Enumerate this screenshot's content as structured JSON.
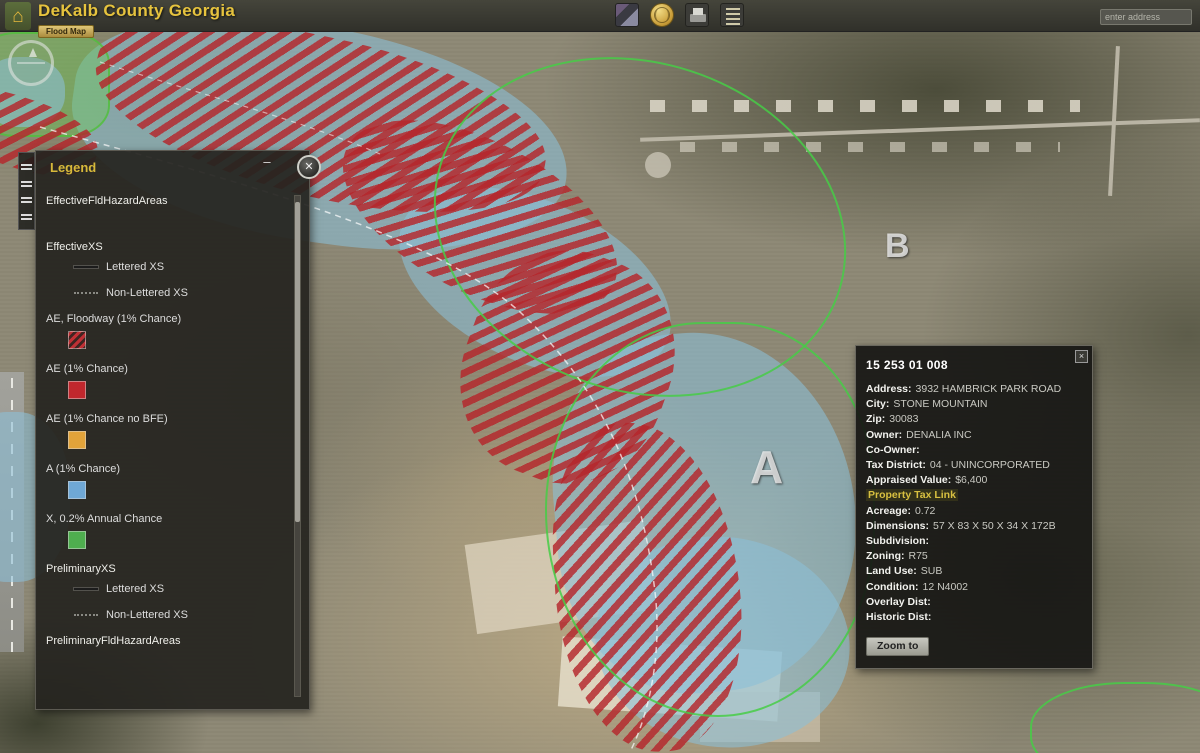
{
  "app": {
    "title": "DeKalb County Georgia",
    "subtitle_button": "Flood Map"
  },
  "header": {
    "search_placeholder": "enter address",
    "toolbar_icons": [
      "basemap-icon",
      "globe-icon",
      "print-icon",
      "layer-list-icon"
    ]
  },
  "legend": {
    "title": "Legend",
    "minimize_label": "–",
    "close_label": "✕",
    "items": [
      {
        "kind": "layer",
        "label": "EffectiveFldHazardAreas"
      },
      {
        "kind": "layer",
        "label": "EffectiveXS"
      },
      {
        "kind": "xs",
        "label": "Lettered XS"
      },
      {
        "kind": "xs",
        "label": "Non-Lettered XS"
      },
      {
        "kind": "class",
        "label": "AE, Floodway (1% Chance)",
        "swatch": "hatch",
        "color": "#b5262b"
      },
      {
        "kind": "class",
        "label": "AE (1% Chance)",
        "swatch": "solid",
        "color": "#c0272d"
      },
      {
        "kind": "class",
        "label": "AE (1% Chance no BFE)",
        "swatch": "solid",
        "color": "#e2a33a"
      },
      {
        "kind": "class",
        "label": "A (1% Chance)",
        "swatch": "solid",
        "color": "#6fa8d6"
      },
      {
        "kind": "class",
        "label": "X, 0.2% Annual Chance",
        "swatch": "solid",
        "color": "#4fae4f"
      },
      {
        "kind": "layer",
        "label": "PreliminaryXS"
      },
      {
        "kind": "xs",
        "label": "Lettered XS"
      },
      {
        "kind": "xs",
        "label": "Non-Lettered XS"
      },
      {
        "kind": "layer",
        "label": "PreliminaryFldHazardAreas"
      }
    ]
  },
  "popup": {
    "title": "15 253 01 008",
    "fields": [
      {
        "label": "Address:",
        "value": "3932 HAMBRICK PARK ROAD"
      },
      {
        "label": "City:",
        "value": "STONE MOUNTAIN"
      },
      {
        "label": "Zip:",
        "value": "30083"
      },
      {
        "label": "Owner:",
        "value": "DENALIA INC"
      },
      {
        "label": "Co-Owner:",
        "value": ""
      },
      {
        "label": "Tax District:",
        "value": "04 - UNINCORPORATED"
      },
      {
        "label": "Appraised Value:",
        "value": "$6,400"
      },
      {
        "label": "Property Tax Link",
        "value": ""
      },
      {
        "label": "Acreage:",
        "value": "0.72"
      },
      {
        "label": "Dimensions:",
        "value": "57 X 83 X 50 X 34 X 172B"
      },
      {
        "label": "Subdivision:",
        "value": ""
      },
      {
        "label": "Zoning:",
        "value": "R75"
      },
      {
        "label": "Land Use:",
        "value": "SUB"
      },
      {
        "label": "Condition:",
        "value": "12 N4002"
      },
      {
        "label": "Overlay Dist:",
        "value": ""
      },
      {
        "label": "Historic Dist:",
        "value": ""
      }
    ],
    "zoom_button": "Zoom to",
    "close_label": "×"
  },
  "map": {
    "labels": {
      "a": "A",
      "b": "B"
    },
    "colors": {
      "flood_fill": "#9cc6dc",
      "floodway_hatch": "#b5262b",
      "boundary_green": "#46c846",
      "accent_yellow": "#e6c33e"
    }
  }
}
